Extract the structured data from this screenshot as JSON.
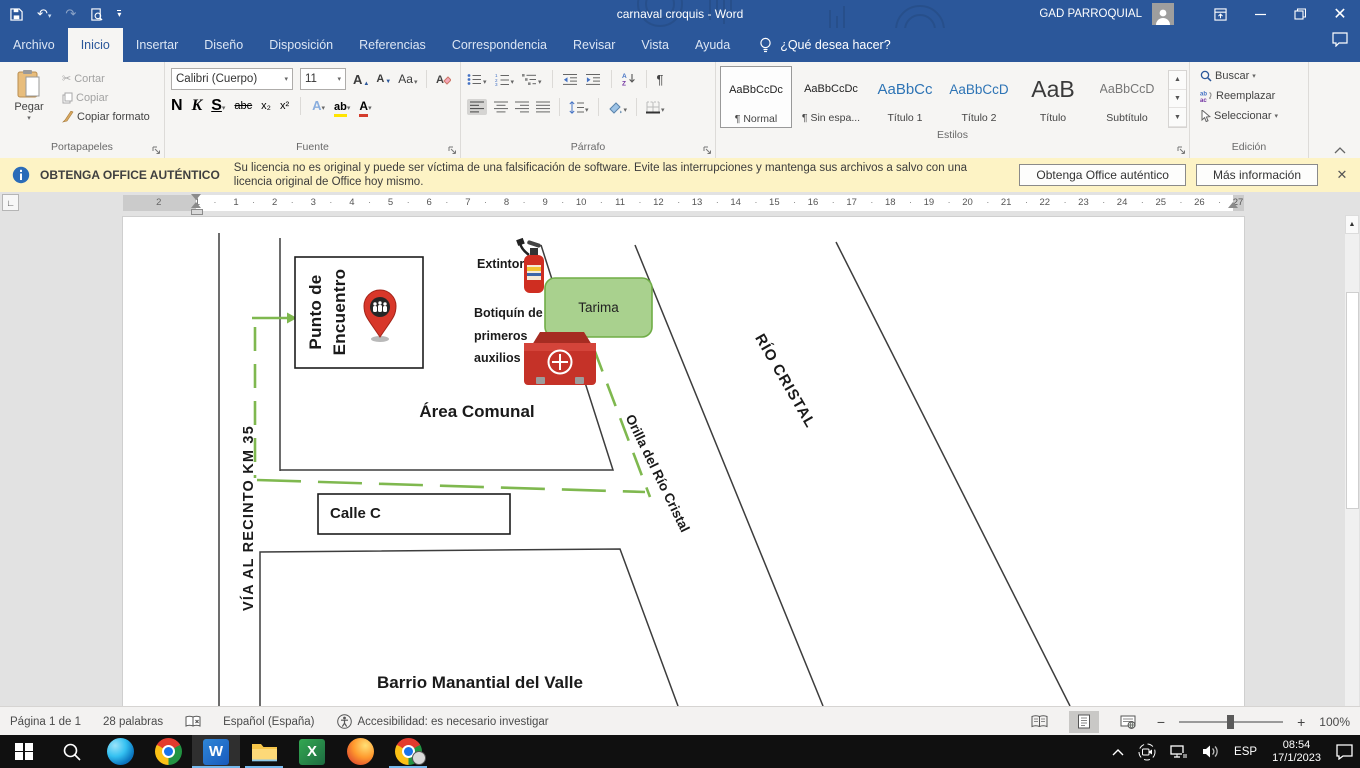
{
  "titlebar": {
    "title": "carnaval croquis  -  Word",
    "user": "GAD PARROQUIAL"
  },
  "tabs": {
    "archivo": "Archivo",
    "inicio": "Inicio",
    "insertar": "Insertar",
    "diseno": "Diseño",
    "disposicion": "Disposición",
    "referencias": "Referencias",
    "correspondencia": "Correspondencia",
    "revisar": "Revisar",
    "vista": "Vista",
    "ayuda": "Ayuda",
    "tellme": "¿Qué desea hacer?"
  },
  "ribbon": {
    "clipboard": {
      "group": "Portapapeles",
      "paste": "Pegar",
      "cut": "Cortar",
      "copy": "Copiar",
      "format_painter": "Copiar formato"
    },
    "font": {
      "group": "Fuente",
      "name": "Calibri (Cuerpo)",
      "size": "11",
      "bold": "N",
      "italic": "K",
      "underline": "S",
      "strike": "abc",
      "subscript": "x₂",
      "superscript": "x²",
      "case_btn": "Aa",
      "grow": "A",
      "shrink": "A",
      "effects": "A",
      "highlight": "ab",
      "font_color": "A"
    },
    "paragraph": {
      "group": "Párrafo"
    },
    "styles": {
      "group": "Estilos",
      "items": [
        {
          "sample": "AaBbCcDc",
          "label": "¶ Normal"
        },
        {
          "sample": "AaBbCcDc",
          "label": "¶ Sin espa..."
        },
        {
          "sample": "AaBbCc",
          "label": "Título 1"
        },
        {
          "sample": "AaBbCcD",
          "label": "Título 2"
        },
        {
          "sample": "AaB",
          "label": "Título"
        },
        {
          "sample": "AaBbCcD",
          "label": "Subtítulo"
        }
      ]
    },
    "editing": {
      "group": "Edición",
      "find": "Buscar",
      "replace": "Reemplazar",
      "select": "Seleccionar"
    }
  },
  "warning": {
    "title": "OBTENGA OFFICE AUTÉNTICO",
    "line1": "Su licencia no es original y puede ser víctima de una falsificación de software. Evite las interrupciones y mantenga sus archivos a salvo con una",
    "line2": "licencia original de Office hoy mismo.",
    "get_button": "Obtenga Office auténtico",
    "info_button": "Más información"
  },
  "ruler": {
    "margin_numbers": [
      "2",
      "1"
    ],
    "numbers": [
      "1",
      "2",
      "3",
      "4",
      "5",
      "6",
      "7",
      "8",
      "9",
      "10",
      "11",
      "12",
      "13",
      "14",
      "15",
      "16",
      "17",
      "18",
      "19",
      "20",
      "21",
      "22",
      "23",
      "24",
      "25",
      "26",
      "27"
    ]
  },
  "map": {
    "punto_line1": "Punto de",
    "punto_line2": "Encuentro",
    "extintor": "Extintor",
    "tarima": "Tarima",
    "botiquin_line1": "Botiquín de",
    "botiquin_line2": "primeros",
    "botiquin_line3": "auxilios",
    "area_comunal": "Área Comunal",
    "calle": "Calle C",
    "via": "VÍA AL RECINTO KM 35",
    "orilla": "Orilla del Río Cristal",
    "rio": "RÍO CRISTAL",
    "barrio": "Barrio Manantial del Valle"
  },
  "statusbar": {
    "page": "Página 1 de 1",
    "words": "28 palabras",
    "language": "Español (España)",
    "accessibility": "Accesibilidad: es necesario investigar",
    "zoom_level": "100%"
  },
  "taskbar": {
    "language": "ESP",
    "time": "08:54",
    "date": "17/1/2023"
  },
  "colors": {
    "accent": "#2b579a",
    "route_green": "#7fb84f",
    "tarima_fill": "#a9d18e",
    "tarima_border": "#70ad47",
    "warning_bg": "#fdf3c5"
  }
}
